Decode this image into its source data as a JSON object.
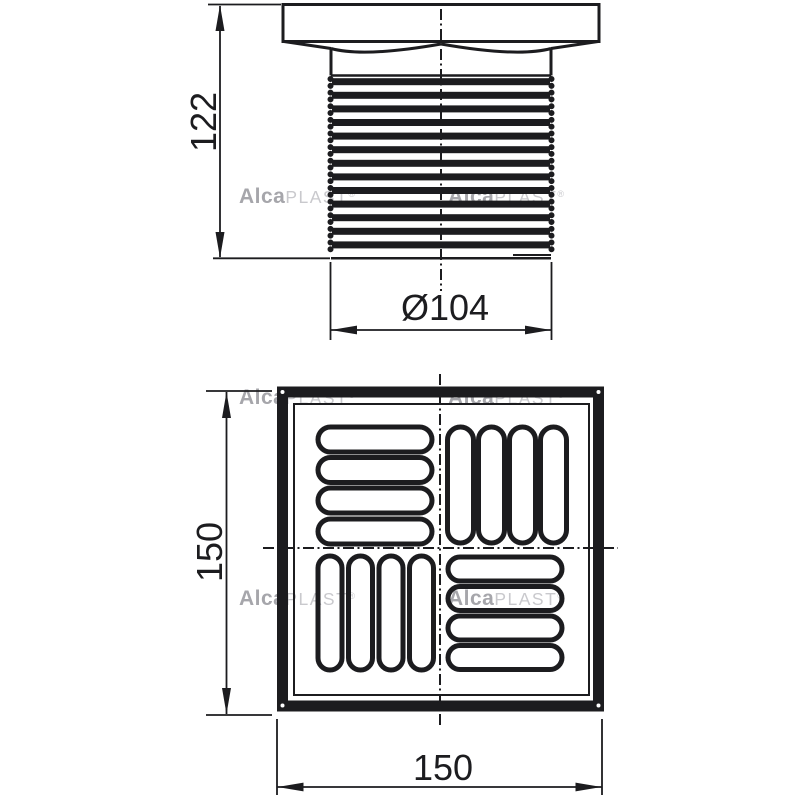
{
  "colors": {
    "background": "#ffffff",
    "ink": "#1c1c1f",
    "watermark_bold": "#a6a6ab",
    "watermark_light": "#c9c9cd"
  },
  "watermark": {
    "bold": "Alca",
    "light": "PLAST",
    "registered": "®"
  },
  "side_view": {
    "height_label": "122",
    "diameter_label": "Ø104"
  },
  "top_view": {
    "height_label": "150",
    "width_label": "150"
  }
}
